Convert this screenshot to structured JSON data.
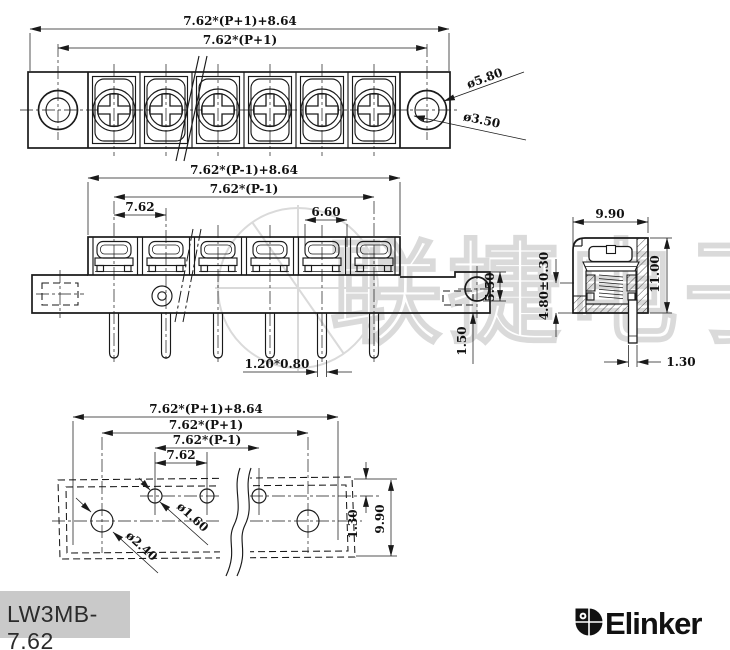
{
  "product": {
    "model": "LW3MB-7.62",
    "brand": "Elinker"
  },
  "watermark": {
    "text": "联捷电子"
  },
  "colors": {
    "line": "#1a1a1a",
    "watermark": "#dadada",
    "label_bg": "#c9c9c9"
  },
  "top_view": {
    "dim_overall": "7.62*(P+1)+8.64",
    "dim_hole_centers": "7.62*(P+1)",
    "dia_outer": "ø5.80",
    "dia_inner": "ø3.50"
  },
  "front_view": {
    "dim_overall": "7.62*(P-1)+8.64",
    "dim_pin_span": "7.62*(P-1)",
    "dim_pitch": "7.62",
    "dim_slot": "6.60",
    "dim_ear_hole": "5.50",
    "dim_standoff": "1.50",
    "dim_pin_section": "1.20*0.80"
  },
  "side_view": {
    "dim_width": "9.90",
    "dim_height": "11.00",
    "dim_mount": "4.80±0.30",
    "dim_pin": "1.30"
  },
  "bottom_view": {
    "dim_overall": "7.62*(P+1)+8.64",
    "dim_mount_centers": "7.62*(P+1)",
    "dim_pin_span": "7.62*(P-1)",
    "dim_pitch": "7.62",
    "dia_pin_hole": "ø1.60",
    "dia_mount_hole": "ø2.40",
    "dim_edge_to_row": "1.30",
    "dim_depth": "9.90"
  }
}
